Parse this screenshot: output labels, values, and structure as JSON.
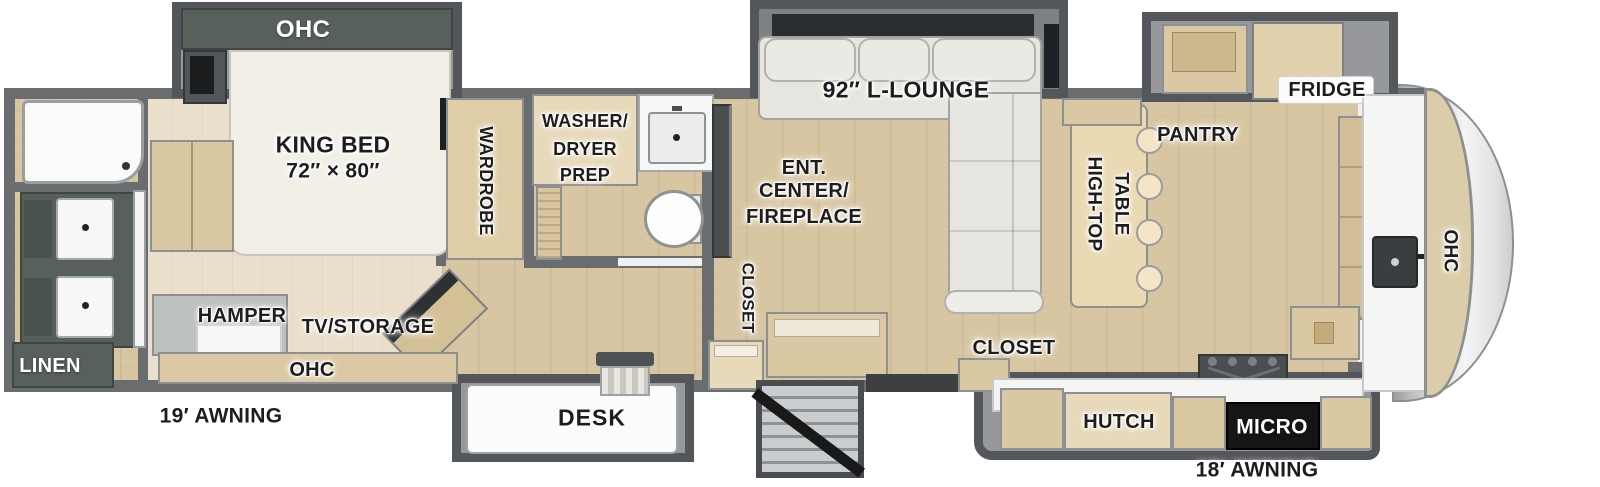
{
  "plan": {
    "bedroom": {
      "ohc_slide": "OHC",
      "king_bed_line1": "KING BED",
      "king_bed_line2": "72″ × 80″",
      "wardrobe": "WARDROBE",
      "hamper": "HAMPER",
      "tv_storage": "TV/STORAGE",
      "ohc_cabinet": "OHC"
    },
    "rear_bathroom": {
      "linen": "LINEN"
    },
    "mid_bathroom": {
      "washer_dryer_line1": "WASHER/",
      "washer_dryer_line2": "DRYER",
      "washer_dryer_line3": "PREP",
      "closet": "CLOSET"
    },
    "living_room": {
      "lounge": "92″ L-LOUNGE",
      "ent_center_line1": "ENT.",
      "ent_center_line2": "CENTER/",
      "ent_center_line3": "FIREPLACE",
      "desk": "DESK",
      "closet": "CLOSET"
    },
    "kitchen": {
      "high_top_line1": "HIGH-TOP",
      "high_top_line2": "TABLE",
      "pantry": "PANTRY",
      "fridge": "FRIDGE",
      "hutch": "HUTCH",
      "micro": "MICRO",
      "ohc_front": "OHC"
    },
    "exterior": {
      "awning_rear": "19′ AWNING",
      "awning_front": "18′ AWNING"
    }
  },
  "colors": {
    "wall": "#6a6d70",
    "slide_wall": "#53565a",
    "floor_wood": "#d8c6a2",
    "bedroom_floor": "#e9dfca",
    "cabinet_wood": "#dac8a2",
    "dark_cabinet": "#57605a",
    "sofa": "#e6e5df",
    "appliance_black": "#141517",
    "front_cap": "#e8e9eb"
  }
}
